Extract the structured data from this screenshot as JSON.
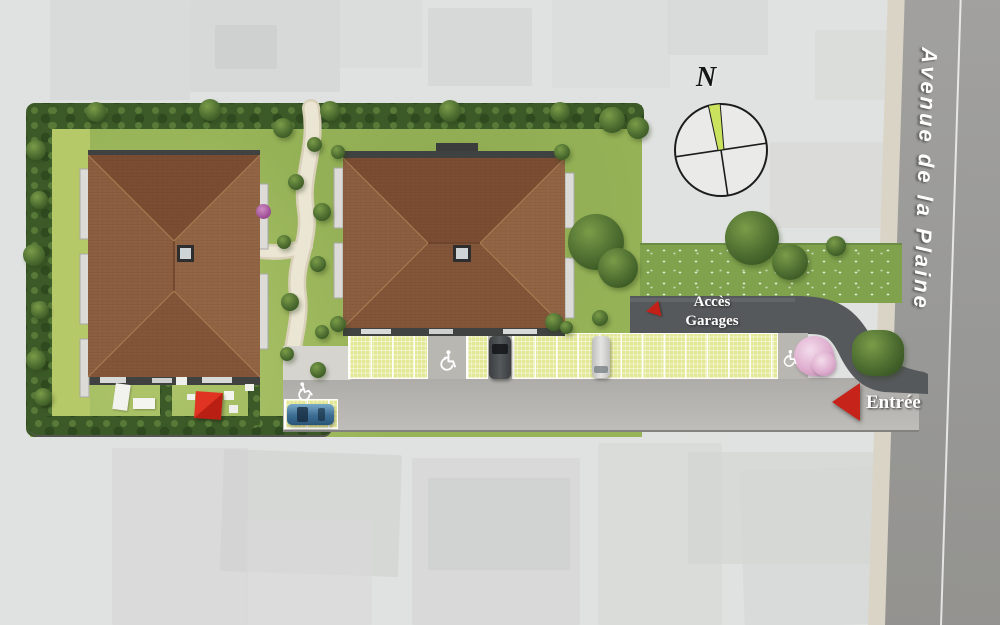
{
  "road": {
    "name": "Avenue de la Plaine"
  },
  "labels": {
    "garage_access": {
      "line1": "Accès",
      "line2": "Garages"
    },
    "entrance": "Entrée"
  },
  "compass": {
    "north_label": "N",
    "needle_color": "#c9e35f"
  },
  "icons": {
    "wheelchair": "♿",
    "entrance_arrow": "left-triangle",
    "garage_arrow": "left-triangle",
    "compass": "compass-rose"
  },
  "colors": {
    "accent_red": "#c6241b",
    "roof_brown": "#8a5c3e",
    "lawn_green": "#98b458",
    "hedge_green": "#3c5a28",
    "paver_green": "#e3e896",
    "dark_road": "#56595c",
    "light_road": "#b3b1ad",
    "avenue_gray": "#9b9a98"
  },
  "site": {
    "buildings_count": 2,
    "accessible_parking_markings": 3,
    "vehicles_visible": [
      "blue car",
      "dark grey car",
      "white van"
    ]
  }
}
